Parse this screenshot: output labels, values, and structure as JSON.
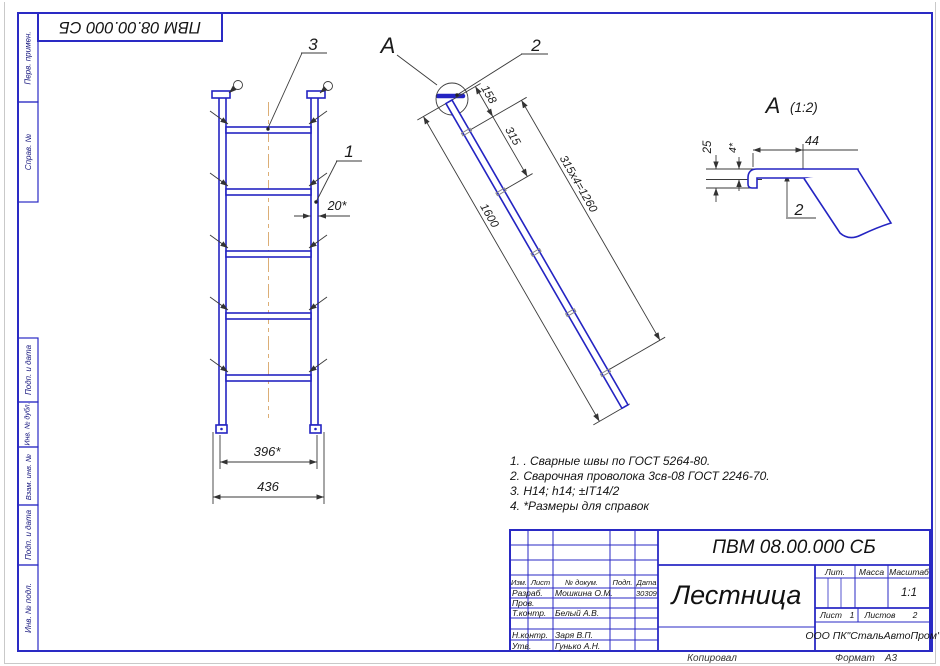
{
  "frame": {
    "designation_top": "ПВМ 08.00.000 СБ",
    "stamp_labels": [
      "Перв. примен.",
      "Справ. №",
      "Подп. и дата",
      "Инв. № дубл.",
      "Взам. инв. №",
      "Подп. и дата",
      "Инв. № подл."
    ],
    "kopiroval": "Копировал",
    "format_label": "Формат",
    "format_value": "А3"
  },
  "front_view": {
    "callout_rung": "3",
    "callout_rail": "1",
    "dim_rail_width": "20*",
    "dim_inner": "396*",
    "dim_outer": "436"
  },
  "side_view": {
    "detail_mark": "A",
    "callout_hook": "2",
    "dim_top": "158",
    "dim_step": "315",
    "dim_chain": "315x4=1260",
    "dim_total": "1600"
  },
  "detail_a": {
    "mark": "A",
    "scale": "(1:2)",
    "dim_length": "44",
    "dim_height": "25",
    "dim_offset": "4*",
    "callout": "2"
  },
  "notes": [
    "1. . Сварные швы по ГОСТ 5264-80.",
    "2.  Сварочная проволока 3св-08 ГОСТ 2246-70.",
    "3.  Н14; h14; ±IT14/2",
    "4.  *Размеры для справок"
  ],
  "title_block": {
    "designation": "ПВМ 08.00.000 СБ",
    "part_name": "Лестница",
    "company": "ООО ПК\"СтальАвтоПром\"",
    "col_izm": "Изм.",
    "col_list": "Лист",
    "col_doc": "№ докум.",
    "col_podp": "Подп.",
    "col_date": "Дата",
    "rows": [
      {
        "role": "Разраб.",
        "person": "Мошкина О.М.",
        "date": "30309"
      },
      {
        "role": "Пров.",
        "person": ""
      },
      {
        "role": "Т.контр.",
        "person": "Белый А.В."
      },
      {
        "role": "Н.контр.",
        "person": "Заря В.П."
      },
      {
        "role": "Утв.",
        "person": "Гунько А.Н."
      }
    ],
    "lit_label": "Лит.",
    "mass_label": "Масса",
    "scale_label": "Масштаб",
    "scale_value": "1:1",
    "sheet_label": "Лист",
    "sheet_value": "1",
    "sheets_label": "Листов",
    "sheets_value": "2"
  }
}
